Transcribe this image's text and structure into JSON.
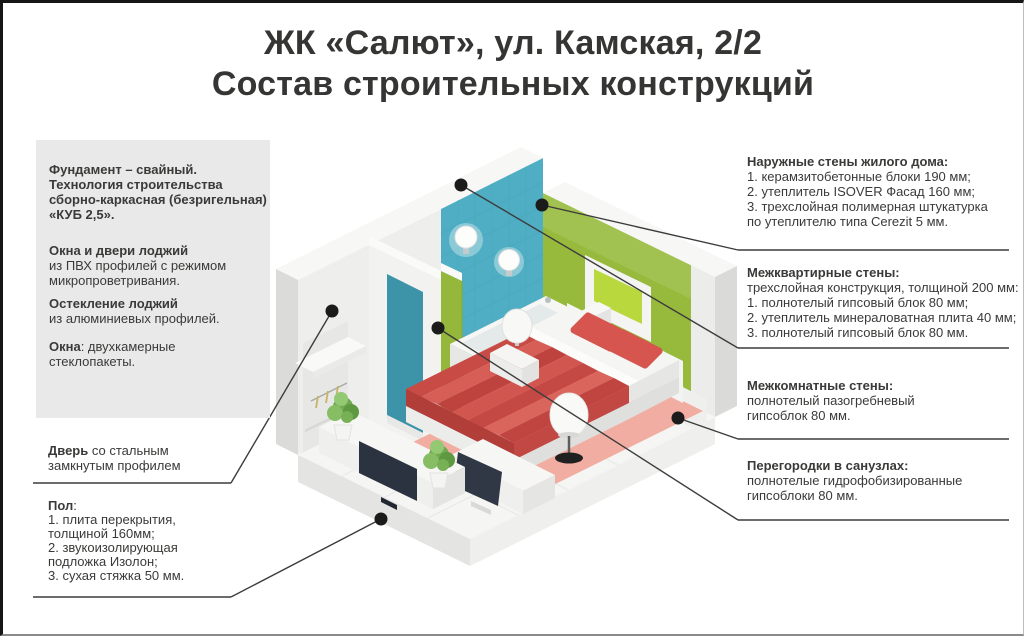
{
  "title": {
    "line1": "ЖК «Салют», ул. Камская, 2/2",
    "line2": "Состав строительных конструкций"
  },
  "left": {
    "info_box": {
      "foundation_lines": [
        "Фундамент – свайный.",
        "Технология строительства",
        "сборно-каркасная (безригельная)",
        "«КУБ 2,5»."
      ],
      "loggia_windows": {
        "bold": "Окна и двери лоджий",
        "lines": [
          "из ПВХ профилей с режимом",
          "микропроветривания."
        ]
      },
      "loggia_glazing": {
        "bold": "Остекление лоджий",
        "lines": [
          "из алюминиевых профилей."
        ]
      },
      "windows": {
        "bold": "Окна",
        "rest": ": двухкамерные",
        "line2": "стеклопакеты."
      }
    },
    "door": {
      "bold": "Дверь",
      "rest": " со стальным",
      "line2": "замкнутым профилем"
    },
    "floor": {
      "bold": "Пол",
      "rest": ":",
      "lines": [
        "1. плита перекрытия,",
        "толщиной 160мм;",
        "2. звукоизолирующая",
        "подложка Изолон;",
        "3. сухая стяжка 50 мм."
      ]
    }
  },
  "right": {
    "blocks": [
      {
        "title": "Наружные стены жилого дома:",
        "lines": [
          "1. керамзитобетонные блоки 190 мм;",
          "2. утеплитель ISOVER Фасад 160 мм;",
          "3. трехслойная полимерная штукатурка",
          "по утеплителю типа Cerezit 5 мм."
        ]
      },
      {
        "title": "Межквартирные стены:",
        "lines": [
          "трехслойная конструкция, толщиной 200 мм:",
          "1. полнотелый гипсовый блок 80 мм;",
          "2. утеплитель минераловатная плита 40 мм;",
          "3. полнотелый гипсовый блок 80 мм."
        ]
      },
      {
        "title": "Межкомнатные стены:",
        "lines": [
          "полнотелый пазогребневый",
          "гипсоблок 80 мм."
        ]
      },
      {
        "title": "Перегородки в санузлах:",
        "lines": [
          "полнотелые гидрофобизированные",
          "гипсоблоки 80 мм."
        ]
      }
    ]
  },
  "colors": {
    "wall_green": "#97BA3D",
    "frame_lime": "#B9D83E",
    "tile_teal": "#4FAEC3",
    "bed_red": "#CE524B",
    "rug_salmon": "#F2ADA2",
    "info_box_bg": "#E9E9E9",
    "callout_line": "#3C3C3C",
    "text": "#3A3A39"
  }
}
